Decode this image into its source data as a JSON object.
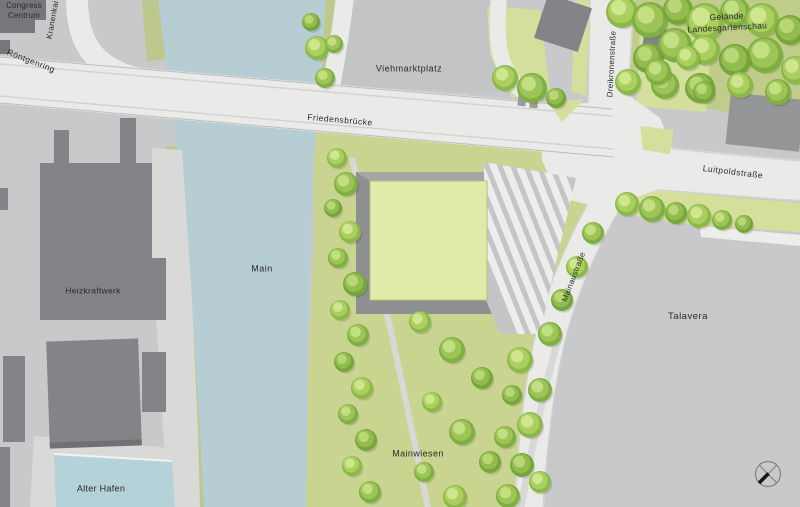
{
  "map": {
    "type": "architectural-site-plan",
    "labels": [
      {
        "id": "congress-centrum",
        "text": "Congress\nCentrum",
        "x": 24,
        "y": 11,
        "rot": 0,
        "size": 8,
        "spacing": 0.2
      },
      {
        "id": "kranenkai",
        "text": "Kranenkai",
        "x": 53,
        "y": 20,
        "rot": -80,
        "size": 8,
        "spacing": 0.3
      },
      {
        "id": "roentgenring",
        "text": "Röntgenring",
        "x": 31,
        "y": 61,
        "rot": 21,
        "size": 8.5,
        "spacing": 0.4
      },
      {
        "id": "viehmarktplatz",
        "text": "Viehmarktplatz",
        "x": 409,
        "y": 69,
        "rot": 0,
        "size": 9,
        "spacing": 0.5
      },
      {
        "id": "gelaende-landesgartenschau",
        "text": "Gelände\nLandesgartenschau",
        "x": 727,
        "y": 22,
        "rot": -3,
        "size": 8.5,
        "spacing": 0.3
      },
      {
        "id": "dreikronenstrasse",
        "text": "Dreikronenstraße",
        "x": 612,
        "y": 64,
        "rot": -87,
        "size": 8,
        "spacing": 0.3
      },
      {
        "id": "friedensbruecke",
        "text": "Friedensbrücke",
        "x": 340,
        "y": 120,
        "rot": 5,
        "size": 8.5,
        "spacing": 0.5
      },
      {
        "id": "luitpoldstrasse",
        "text": "Luitpoldstraße",
        "x": 733,
        "y": 172,
        "rot": 7,
        "size": 8.5,
        "spacing": 0.5
      },
      {
        "id": "main-river",
        "text": "Main",
        "x": 262,
        "y": 269,
        "rot": 0,
        "size": 9,
        "spacing": 0.5
      },
      {
        "id": "heizkraftwerk",
        "text": "Heizkraftwerk",
        "x": 93,
        "y": 291,
        "rot": 0,
        "size": 8.5,
        "spacing": 0.3
      },
      {
        "id": "mainaustrasse",
        "text": "Mainaustraße",
        "x": 574,
        "y": 277,
        "rot": -69,
        "size": 8,
        "spacing": 0.3
      },
      {
        "id": "talavera",
        "text": "Talavera",
        "x": 688,
        "y": 317,
        "rot": 0,
        "size": 9.5,
        "spacing": 0.5
      },
      {
        "id": "mainwiesen",
        "text": "Mainwiesen",
        "x": 418,
        "y": 454,
        "rot": 0,
        "size": 9,
        "spacing": 0.4
      },
      {
        "id": "alter-hafen",
        "text": "Alter Hafen",
        "x": 101,
        "y": 489,
        "rot": 0,
        "size": 9,
        "spacing": 0.3
      }
    ],
    "compass_icon": "north-arrow-circle-cross",
    "colors": {
      "plaza": "#c8c9ca",
      "road": "#eaebe9",
      "river": "#b6cdd3",
      "harbor_basin": "#b4d2d7",
      "bank": "#bdc88c",
      "meadow": "#c9d491",
      "lawn": "#d3df9b",
      "ground_garden": "#c0cd8a",
      "building_dark": "#75777a",
      "building_mid": "#828488",
      "site_square": "#e2eaa9",
      "platform": "#a3a5a7",
      "quay": "#d9dad8"
    },
    "tree_palettes": [
      {
        "base": "#9cc457",
        "hi": "#c6e287",
        "dk": "#7fae42"
      },
      {
        "base": "#aacf5f",
        "hi": "#d2e892",
        "dk": "#8cb84a"
      },
      {
        "base": "#92bd4e",
        "hi": "#bcd97c",
        "dk": "#76a53c"
      }
    ],
    "trees": [
      [
        622,
        12,
        16,
        1
      ],
      [
        650,
        20,
        18,
        0
      ],
      [
        678,
        10,
        15,
        2
      ],
      [
        705,
        22,
        19,
        1
      ],
      [
        735,
        12,
        15,
        0
      ],
      [
        762,
        20,
        17,
        1
      ],
      [
        790,
        30,
        15,
        2
      ],
      [
        795,
        70,
        14,
        1
      ],
      [
        765,
        55,
        18,
        0
      ],
      [
        735,
        60,
        16,
        2
      ],
      [
        705,
        50,
        15,
        1
      ],
      [
        675,
        45,
        17,
        0
      ],
      [
        648,
        58,
        15,
        2
      ],
      [
        628,
        82,
        13,
        1
      ],
      [
        665,
        85,
        14,
        0
      ],
      [
        700,
        88,
        15,
        2
      ],
      [
        740,
        85,
        13,
        1
      ],
      [
        778,
        92,
        13,
        0
      ],
      [
        317,
        48,
        12,
        1
      ],
      [
        325,
        78,
        10,
        0
      ],
      [
        311,
        22,
        9,
        2
      ],
      [
        334,
        44,
        9,
        0
      ],
      [
        505,
        78,
        13,
        1
      ],
      [
        532,
        88,
        15,
        0
      ],
      [
        556,
        98,
        10,
        2
      ],
      [
        658,
        72,
        13,
        0
      ],
      [
        688,
        58,
        12,
        1
      ],
      [
        704,
        92,
        11,
        2
      ],
      [
        627,
        204,
        12,
        1
      ],
      [
        652,
        209,
        13,
        0
      ],
      [
        676,
        213,
        11,
        2
      ],
      [
        699,
        216,
        12,
        1
      ],
      [
        722,
        220,
        10,
        0
      ],
      [
        744,
        224,
        9,
        2
      ],
      [
        593,
        233,
        11,
        0
      ],
      [
        577,
        267,
        11,
        1
      ],
      [
        562,
        300,
        11,
        2
      ],
      [
        550,
        334,
        12,
        0
      ],
      [
        520,
        360,
        13,
        1
      ],
      [
        540,
        390,
        12,
        0
      ],
      [
        512,
        395,
        10,
        2
      ],
      [
        530,
        425,
        13,
        1
      ],
      [
        505,
        437,
        11,
        0
      ],
      [
        522,
        465,
        12,
        2
      ],
      [
        540,
        482,
        11,
        1
      ],
      [
        508,
        496,
        12,
        0
      ],
      [
        337,
        158,
        10,
        1
      ],
      [
        346,
        184,
        12,
        0
      ],
      [
        333,
        208,
        9,
        2
      ],
      [
        350,
        232,
        11,
        1
      ],
      [
        338,
        258,
        10,
        0
      ],
      [
        355,
        284,
        12,
        2
      ],
      [
        340,
        310,
        10,
        1
      ],
      [
        358,
        335,
        11,
        0
      ],
      [
        344,
        362,
        10,
        2
      ],
      [
        362,
        388,
        11,
        1
      ],
      [
        348,
        414,
        10,
        0
      ],
      [
        366,
        440,
        11,
        2
      ],
      [
        352,
        466,
        10,
        1
      ],
      [
        370,
        492,
        11,
        0
      ],
      [
        420,
        322,
        11,
        1
      ],
      [
        452,
        350,
        13,
        0
      ],
      [
        482,
        378,
        11,
        2
      ],
      [
        432,
        402,
        10,
        1
      ],
      [
        462,
        432,
        13,
        0
      ],
      [
        490,
        462,
        11,
        2
      ],
      [
        424,
        472,
        10,
        0
      ],
      [
        455,
        497,
        12,
        1
      ]
    ]
  }
}
